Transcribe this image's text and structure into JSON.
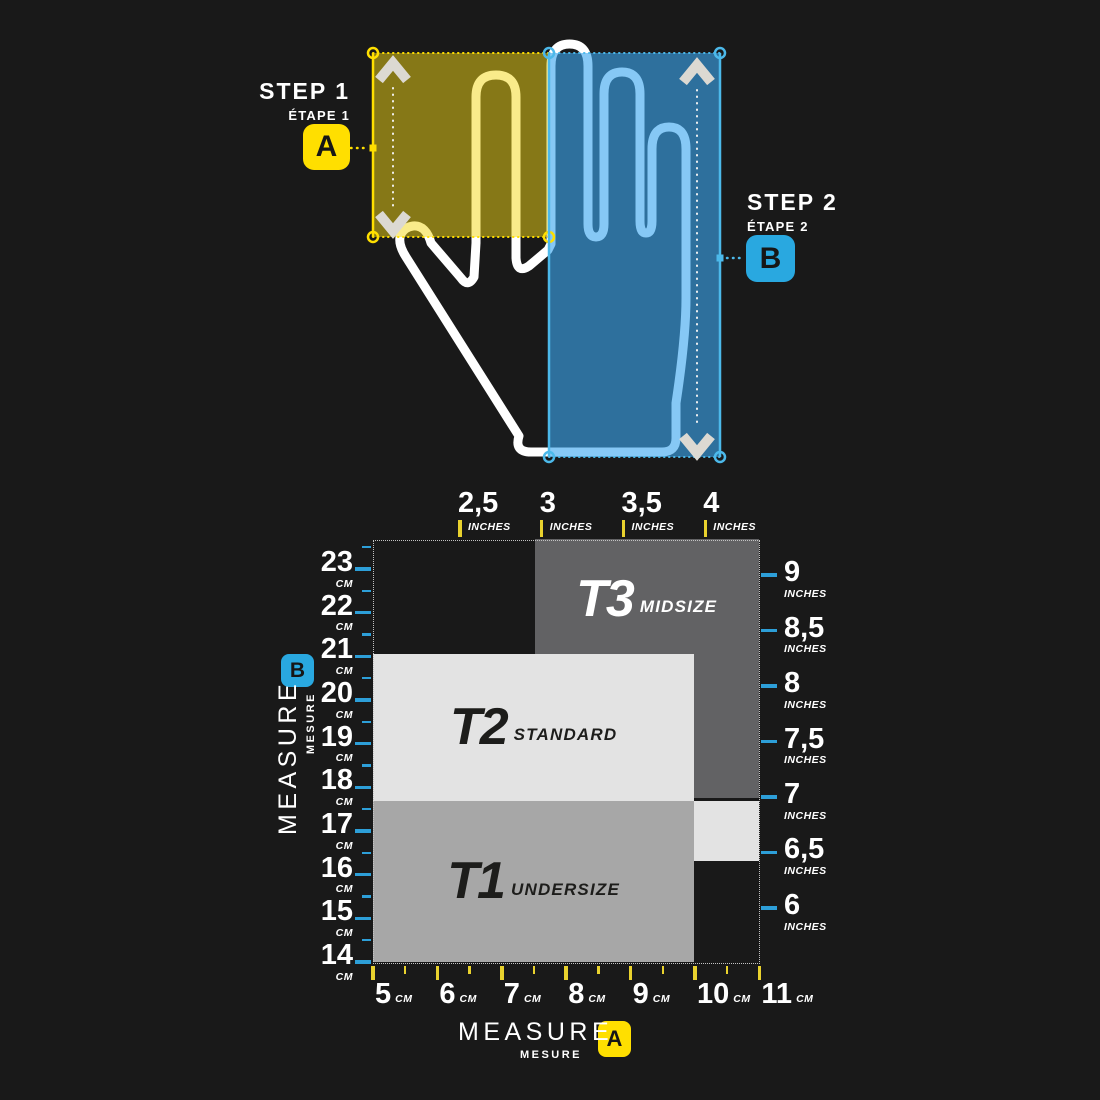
{
  "colors": {
    "background": "#191919",
    "accent_yellow": "#ffdf00",
    "accent_blue": "#29a8e0",
    "tick_yellow": "#e9d22e",
    "tick_blue": "#2d9fd8",
    "overlay_yellow": "#f4d815",
    "overlay_blue": "#3ba7ef",
    "hand_outline": "#ffffff",
    "zone_t3": "#626264",
    "zone_t2": "#e3e3e3",
    "zone_t1": "#a7a7a7"
  },
  "steps": {
    "step1": {
      "title": "STEP 1",
      "subtitle": "ÉTAPE 1",
      "badge": "A"
    },
    "step2": {
      "title": "STEP 2",
      "subtitle": "ÉTAPE 2",
      "badge": "B"
    }
  },
  "measure_labels": {
    "left": {
      "title": "MEASURE",
      "subtitle": "MESURE",
      "badge": "B"
    },
    "bottom": {
      "title": "MEASURE",
      "subtitle": "MESURE",
      "badge": "A"
    }
  },
  "chart_data": {
    "type": "area",
    "title": "",
    "grid": "off",
    "legend_position": "none",
    "x_axis_bottom": {
      "measure": "A",
      "unit": "CM",
      "ticks": [
        "5",
        "6",
        "7",
        "8",
        "9",
        "10",
        "11"
      ],
      "minor_step_cm": 0.5,
      "range_cm": [
        5,
        11
      ]
    },
    "x_axis_top": {
      "measure": "A",
      "unit": "INCHES",
      "ticks": [
        "2,5",
        "3",
        "3,5",
        "4"
      ]
    },
    "y_axis_left": {
      "measure": "B",
      "unit": "CM",
      "ticks": [
        "23",
        "22",
        "21",
        "20",
        "19",
        "18",
        "17",
        "16",
        "15",
        "14"
      ],
      "minor_step_cm": 0.5,
      "range_cm": [
        13.9,
        23.7
      ]
    },
    "y_axis_right": {
      "measure": "B",
      "unit": "INCHES",
      "ticks": [
        "9",
        "8,5",
        "8",
        "7,5",
        "7",
        "6,5",
        "6"
      ]
    },
    "zones": [
      {
        "id": "T3",
        "name": "MIDSIZE",
        "x_cm": [
          7.51,
          10.99
        ],
        "y_cm": [
          17.75,
          23.69
        ],
        "color": "#626264",
        "text_color": "#ffffff",
        "label_align": "upper"
      },
      {
        "id": "T2",
        "name": "STANDARD",
        "x_cm": [
          5.0,
          9.99
        ],
        "y_cm": [
          17.69,
          21.06
        ],
        "color": "#e3e3e3",
        "text_color": "#1d1d1b",
        "label_align": "center"
      },
      {
        "id": "T1",
        "name": "UNDERSIZE",
        "x_cm": [
          5.0,
          9.99
        ],
        "y_cm": [
          14.0,
          17.69
        ],
        "color": "#a7a7a7",
        "text_color": "#1d1d1b",
        "label_align": "center"
      },
      {
        "id": "",
        "name": "",
        "x_cm": [
          9.99,
          10.99
        ],
        "y_cm": [
          16.31,
          17.69
        ],
        "color": "#e3e3e3",
        "text_color": "#1d1d1b",
        "label_align": "center"
      }
    ]
  }
}
